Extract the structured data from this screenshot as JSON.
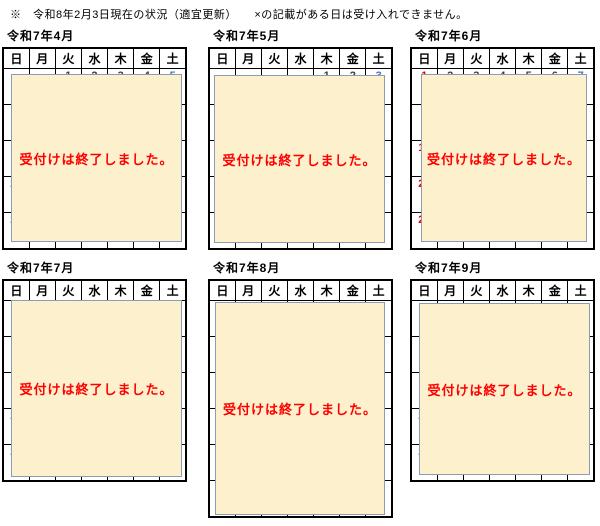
{
  "page": {
    "note": "※　令和8年2月3日現在の状況（適宜更新）　　×の記載がある日は受け入れできません。"
  },
  "weekdays": [
    "日",
    "月",
    "火",
    "水",
    "木",
    "金",
    "土"
  ],
  "overlay_message": "受付けは終了しました。",
  "colors": {
    "sunday": "#e00000",
    "saturday": "#4472c4",
    "holiday": "#e00000",
    "weekday": "#404040",
    "unavailable_cell_bg": "#bfbfbf",
    "overlay_bg": "#fcf0cd",
    "overlay_border": "#8d9cb5",
    "message_red": "#ff0000"
  },
  "closed_mark": "×",
  "calendars": [
    {
      "title": "令和7年4月",
      "weeks": [
        [
          null,
          null,
          [
            "1",
            "wd"
          ],
          [
            "2",
            "wd"
          ],
          [
            "3",
            "wd"
          ],
          [
            "4",
            "wd"
          ],
          [
            "5",
            "sat"
          ]
        ],
        [
          [
            "6",
            "sun"
          ],
          [
            "7",
            "wd"
          ],
          [
            "8",
            "wd"
          ],
          [
            "9",
            "wd"
          ],
          [
            "10",
            "wd"
          ],
          [
            "11",
            "wd"
          ],
          [
            "12",
            "sat"
          ]
        ],
        [
          [
            "13",
            "sun"
          ],
          [
            "14",
            "wd"
          ],
          [
            "15",
            "wd"
          ],
          [
            "16",
            "wd"
          ],
          [
            "17",
            "wd"
          ],
          [
            "18",
            "wd"
          ],
          [
            "19",
            "sat"
          ]
        ],
        [
          [
            "20",
            "sun"
          ],
          [
            "21",
            "wd"
          ],
          [
            "22",
            "wd"
          ],
          [
            "23",
            "wd"
          ],
          [
            "24",
            "wd"
          ],
          [
            "25",
            "wd"
          ],
          [
            "26",
            "sat"
          ]
        ],
        [
          [
            "27",
            "sun"
          ],
          [
            "28",
            "wd"
          ],
          [
            "29",
            "hol"
          ],
          [
            "30",
            "wd"
          ],
          null,
          null,
          null
        ]
      ]
    },
    {
      "title": "令和7年5月",
      "weeks": [
        [
          null,
          null,
          null,
          null,
          [
            "1",
            "wd"
          ],
          [
            "2",
            "wd"
          ],
          [
            "3",
            "sat"
          ]
        ],
        [
          [
            "4",
            "sun"
          ],
          [
            "5",
            "hol"
          ],
          [
            "6",
            "hol"
          ],
          [
            "7",
            "wd"
          ],
          [
            "8",
            "wd"
          ],
          [
            "9",
            "wd"
          ],
          [
            "10",
            "sat"
          ]
        ],
        [
          [
            "11",
            "sun"
          ],
          [
            "12",
            "wd"
          ],
          [
            "13",
            "wd"
          ],
          [
            "14",
            "wd"
          ],
          [
            "15",
            "wd"
          ],
          [
            "16",
            "wd"
          ],
          [
            "17",
            "sat"
          ]
        ],
        [
          [
            "18",
            "sun"
          ],
          [
            "19",
            "wd"
          ],
          [
            "20",
            "wd"
          ],
          [
            "21",
            "wd"
          ],
          [
            "22",
            "wd"
          ],
          [
            "23",
            "wd"
          ],
          [
            "24",
            "sat"
          ]
        ],
        [
          [
            "25",
            "sun"
          ],
          [
            "26",
            "wd",
            "×"
          ],
          [
            "27",
            "wd"
          ],
          [
            "28",
            "wd"
          ],
          [
            "29",
            "wd"
          ],
          [
            "30",
            "wd"
          ],
          [
            "31",
            "sat"
          ]
        ]
      ]
    },
    {
      "title": "令和7年6月",
      "weeks": [
        [
          [
            "1",
            "sun"
          ],
          [
            "2",
            "wd"
          ],
          [
            "3",
            "wd"
          ],
          [
            "4",
            "wd"
          ],
          [
            "5",
            "wd"
          ],
          [
            "6",
            "wd"
          ],
          [
            "7",
            "sat"
          ]
        ],
        [
          [
            "8",
            "sun"
          ],
          [
            "9",
            "wd"
          ],
          [
            "10",
            "wd"
          ],
          [
            "11",
            "wd"
          ],
          [
            "12",
            "wd"
          ],
          [
            "13",
            "wd"
          ],
          [
            "14",
            "sat"
          ]
        ],
        [
          [
            "15",
            "sun"
          ],
          [
            "16",
            "wd"
          ],
          [
            "17",
            "wd"
          ],
          [
            "18",
            "wd"
          ],
          [
            "19",
            "wd"
          ],
          [
            "20",
            "wd"
          ],
          [
            "21",
            "sat"
          ]
        ],
        [
          [
            "22",
            "sun"
          ],
          [
            "23",
            "wd"
          ],
          [
            "24",
            "wd"
          ],
          [
            "25",
            "wd"
          ],
          [
            "26",
            "wd"
          ],
          [
            "27",
            "wd"
          ],
          [
            "28",
            "sat"
          ]
        ],
        [
          [
            "29",
            "sun"
          ],
          [
            "30",
            "wd"
          ],
          null,
          null,
          null,
          null,
          null
        ]
      ]
    },
    {
      "title": "令和7年7月",
      "weeks": [
        [
          null,
          null,
          [
            "1",
            "wd"
          ],
          [
            "2",
            "wd"
          ],
          [
            "3",
            "wd"
          ],
          [
            "4",
            "wd"
          ],
          [
            "5",
            "sat"
          ]
        ],
        [
          [
            "6",
            "sun"
          ],
          [
            "7",
            "wd"
          ],
          [
            "8",
            "wd"
          ],
          [
            "9",
            "wd"
          ],
          [
            "10",
            "wd"
          ],
          [
            "11",
            "wd"
          ],
          [
            "12",
            "sat"
          ]
        ],
        [
          [
            "13",
            "sun"
          ],
          [
            "14",
            "wd"
          ],
          [
            "15",
            "wd"
          ],
          [
            "16",
            "wd"
          ],
          [
            "17",
            "wd"
          ],
          [
            "18",
            "wd"
          ],
          [
            "19",
            "sat"
          ]
        ],
        [
          [
            "20",
            "sun"
          ],
          [
            "21",
            "hol"
          ],
          [
            "22",
            "wd"
          ],
          [
            "23",
            "wd"
          ],
          [
            "24",
            "wd"
          ],
          [
            "25",
            "wd"
          ],
          [
            "26",
            "sat"
          ]
        ],
        [
          [
            "27",
            "sun"
          ],
          [
            "28",
            "wd"
          ],
          [
            "29",
            "wd"
          ],
          [
            "30",
            "wd"
          ],
          [
            "31",
            "wd"
          ],
          null,
          null
        ]
      ]
    },
    {
      "title": "令和7年8月",
      "weeks": [
        [
          null,
          null,
          null,
          null,
          null,
          [
            "1",
            "wd"
          ],
          [
            "2",
            "sat"
          ]
        ],
        [
          [
            "3",
            "sun"
          ],
          [
            "4",
            "wd"
          ],
          [
            "5",
            "wd"
          ],
          [
            "6",
            "wd"
          ],
          [
            "7",
            "wd"
          ],
          [
            "8",
            "wd"
          ],
          [
            "9",
            "sat"
          ]
        ],
        [
          [
            "10",
            "sun"
          ],
          [
            "11",
            "hol"
          ],
          [
            "12",
            "wd"
          ],
          [
            "13",
            "wd"
          ],
          [
            "14",
            "wd"
          ],
          [
            "15",
            "wd"
          ],
          [
            "16",
            "sat"
          ]
        ],
        [
          [
            "17",
            "sun"
          ],
          [
            "18",
            "wd"
          ],
          [
            "19",
            "wd"
          ],
          [
            "20",
            "wd"
          ],
          [
            "21",
            "wd"
          ],
          [
            "22",
            "wd"
          ],
          [
            "23",
            "sat"
          ]
        ],
        [
          [
            "24",
            "sun"
          ],
          [
            "25",
            "wd"
          ],
          [
            "26",
            "wd"
          ],
          [
            "27",
            "wd"
          ],
          [
            "28",
            "wd"
          ],
          [
            "29",
            "wd"
          ],
          [
            "30",
            "sat"
          ]
        ],
        [
          [
            "31",
            "sun"
          ],
          null,
          null,
          null,
          null,
          null,
          null
        ]
      ]
    },
    {
      "title": "令和7年9月",
      "weeks": [
        [
          null,
          [
            "1",
            "wd"
          ],
          [
            "2",
            "wd"
          ],
          [
            "3",
            "wd"
          ],
          [
            "4",
            "wd"
          ],
          [
            "5",
            "wd"
          ],
          [
            "6",
            "sat"
          ]
        ],
        [
          [
            "7",
            "sun"
          ],
          [
            "8",
            "wd"
          ],
          [
            "9",
            "wd"
          ],
          [
            "10",
            "wd"
          ],
          [
            "11",
            "wd"
          ],
          [
            "12",
            "wd"
          ],
          [
            "13",
            "sat"
          ]
        ],
        [
          [
            "14",
            "sun"
          ],
          [
            "15",
            "hol"
          ],
          [
            "16",
            "wd"
          ],
          [
            "17",
            "wd"
          ],
          [
            "18",
            "wd"
          ],
          [
            "19",
            "wd"
          ],
          [
            "20",
            "sat"
          ]
        ],
        [
          [
            "21",
            "sun"
          ],
          [
            "22",
            "wd"
          ],
          [
            "23",
            "hol"
          ],
          [
            "24",
            "wd"
          ],
          [
            "25",
            "wd"
          ],
          [
            "26",
            "wd"
          ],
          [
            "27",
            "sat"
          ]
        ],
        [
          [
            "28",
            "sun"
          ],
          [
            "29",
            "wd"
          ],
          [
            "30",
            "wd"
          ],
          null,
          null,
          null,
          null
        ]
      ]
    }
  ]
}
